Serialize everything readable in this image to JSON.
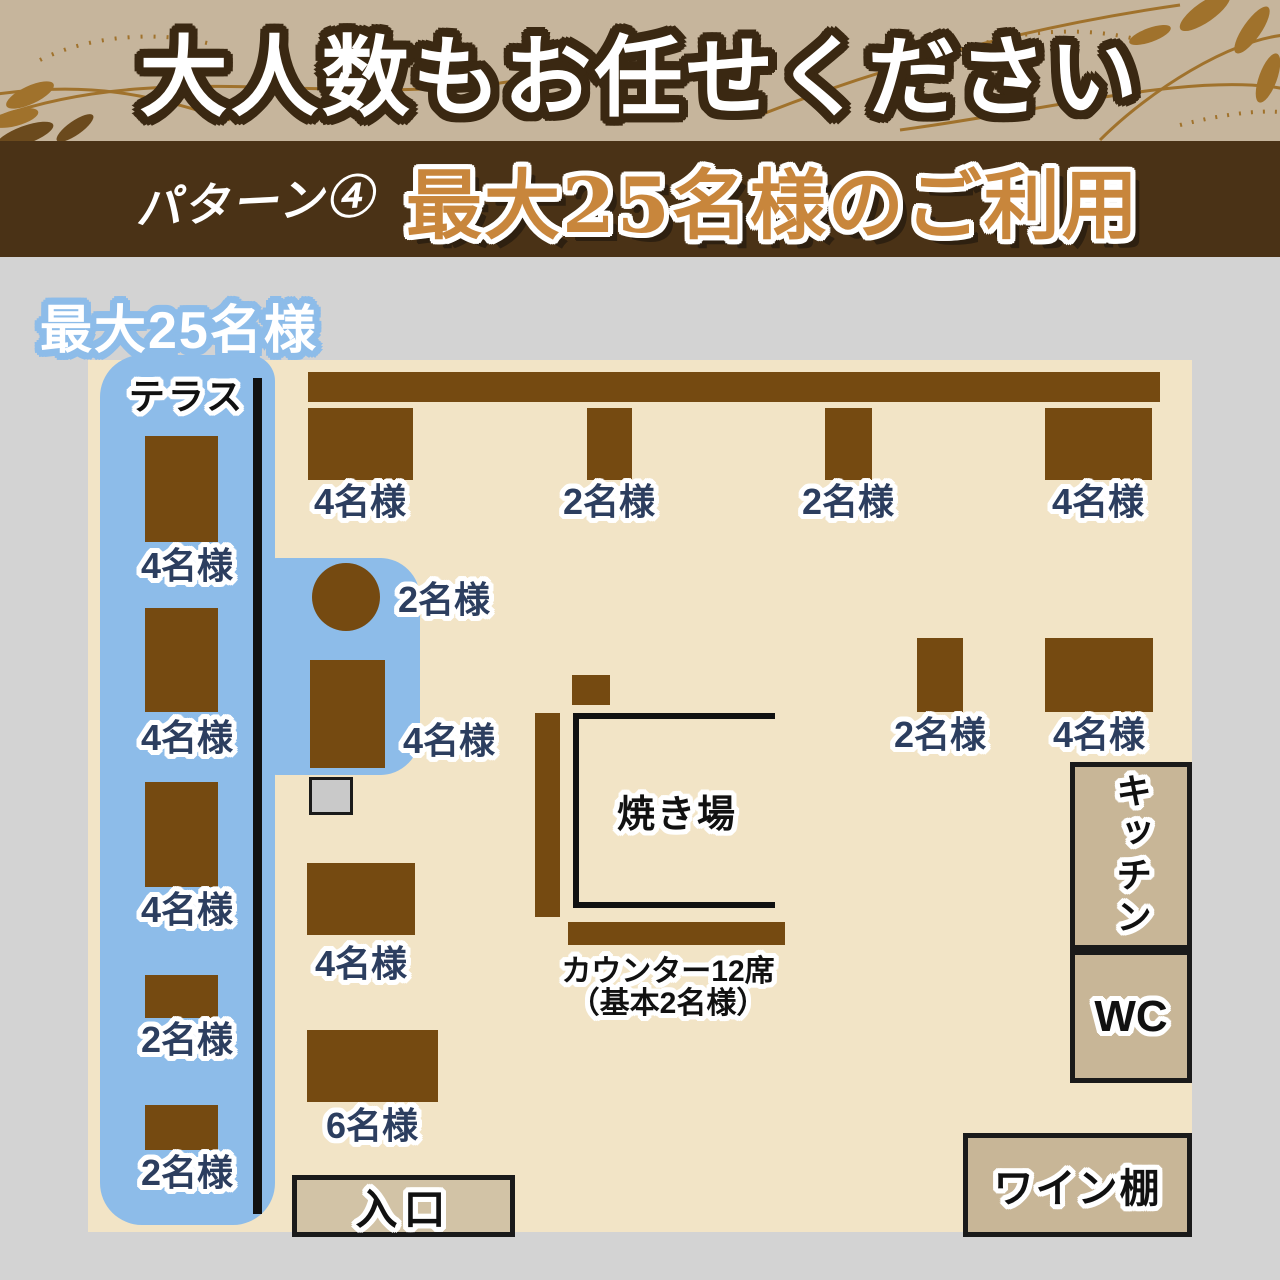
{
  "banner": {
    "title": "大人数もお任せください"
  },
  "pattern_bar": {
    "label": "パターン④",
    "title": "最大25名様のご利用"
  },
  "floorplan": {
    "capacity_badge": "最大25名様",
    "terrace_label": "テラス",
    "grill_label": "焼き場",
    "counter_note_line1": "カウンター12席",
    "counter_note_line2": "（基本2名様）",
    "kitchen_label": "キッチン",
    "wc_label": "WC",
    "wine_label": "ワイン棚",
    "entrance_label": "入口",
    "tables": {
      "terrace_1": "4名様",
      "terrace_2": "4名様",
      "terrace_3": "4名様",
      "terrace_4": "2名様",
      "terrace_5": "2名様",
      "top_1": "4名様",
      "top_2": "2名様",
      "top_3": "2名様",
      "top_4": "4名様",
      "round_2": "2名様",
      "blue_4": "4名様",
      "right_2": "2名様",
      "right_4": "4名様",
      "mid_4": "4名様",
      "mid_6": "6名様"
    }
  },
  "colors": {
    "page_background": "#d3d3d3",
    "banner_background": "#c6b59c",
    "banner_text_outline": "#3a2812",
    "pattern_bar_background": "#4a3216",
    "pattern_title_gold": "#c8863c",
    "floor_background": "#f2e4c6",
    "terrace_blue": "#8dbce9",
    "table_brown": "#754a11",
    "seat_label_navy": "#2c3e5f",
    "service_box_fill": "#c8b697"
  }
}
